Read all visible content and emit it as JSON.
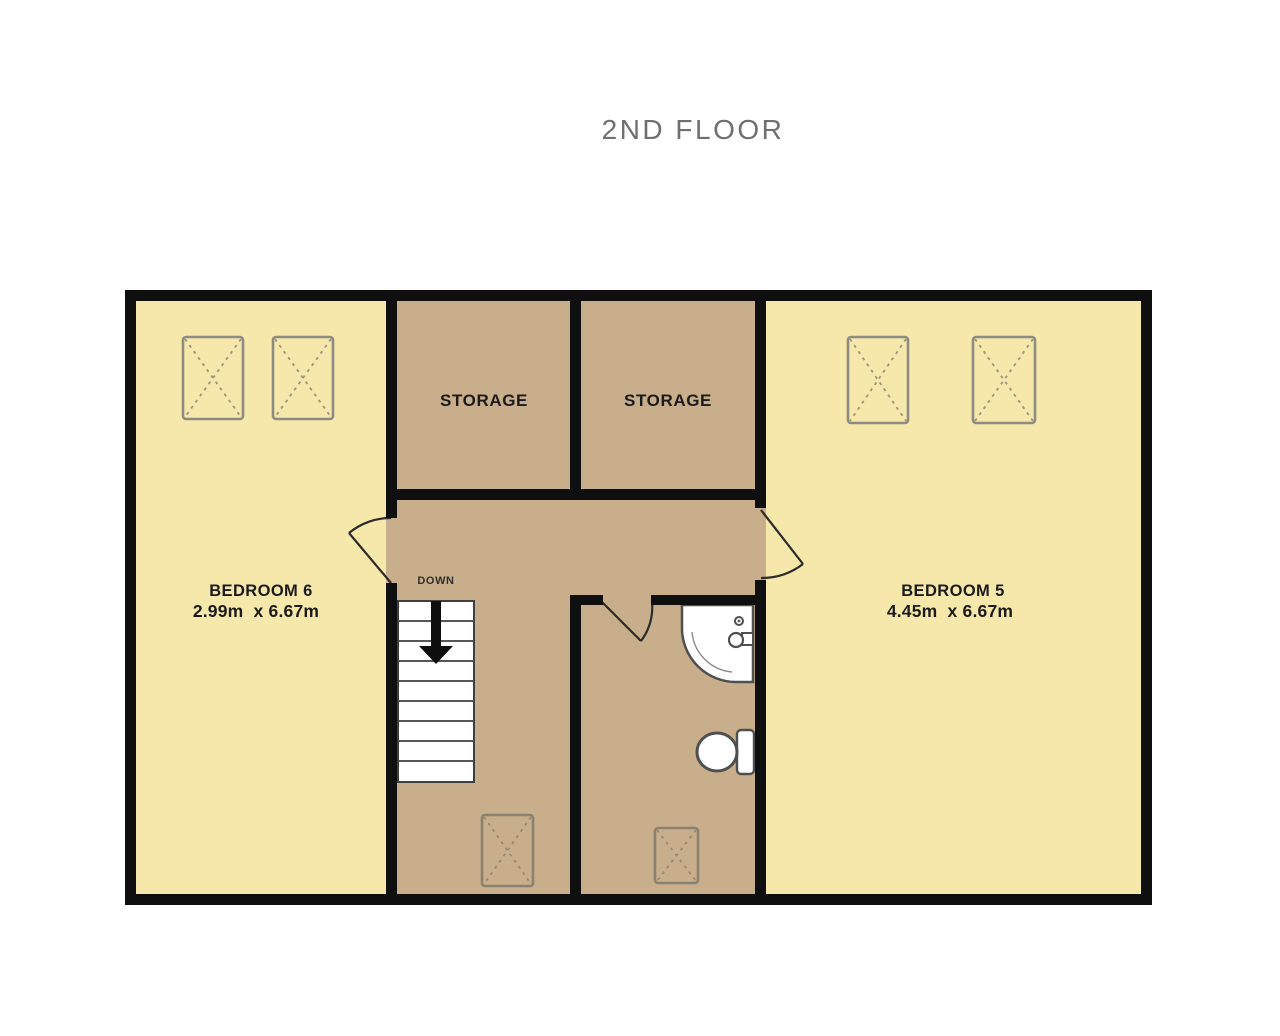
{
  "title": "2ND FLOOR",
  "floor_plan": {
    "rooms": {
      "bedroom6": {
        "name": "BEDROOM 6",
        "dims": "2.99m  x 6.67m"
      },
      "bedroom5": {
        "name": "BEDROOM 5",
        "dims": "4.45m  x 6.67m"
      },
      "storage_left": {
        "name": "STORAGE"
      },
      "storage_right": {
        "name": "STORAGE"
      },
      "landing": {
        "stairs_label": "DOWN"
      }
    },
    "colors": {
      "wall": "#0f0f0f",
      "bedroom_fill": "#f6e7ab",
      "hallway_fill": "#c8ae8a",
      "door_stroke": "#2b2b2b",
      "skylight_stroke_light": "#8d8c82",
      "skylight_cross_light": "#9b947f",
      "skylight_stroke_dark": "#8a8170",
      "skylight_cross_dark": "#948a76",
      "label_text": "#1b1b1b",
      "down_text": "#2f2f2f",
      "title_text": "#6f6f6f"
    }
  }
}
